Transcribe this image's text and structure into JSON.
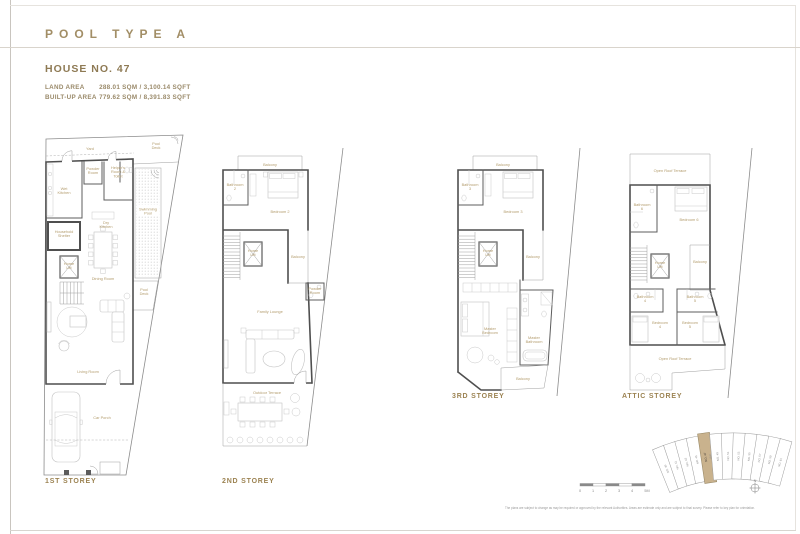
{
  "header": {
    "title": "POOL TYPE A",
    "house_name": "HOUSE NO. 47",
    "land_area_label": "LAND AREA",
    "land_area_value": "288.01 SQM / 3,100.14 SQFT",
    "built_up_area_label": "BUILT-UP AREA",
    "built_up_area_value": "779.62 SQM / 8,391.83 SQFT"
  },
  "plans": [
    {
      "label": "1ST STOREY",
      "rooms": {
        "yard": "Yard",
        "pool_deck_top": "Pool|Deck",
        "powder_room": "Powder|Room",
        "helpers_room": "Helper's|Room &|Toilet",
        "wet_kitchen": "Wet|Kitchen",
        "dry_kitchen": "Dry|Kitchen",
        "swimming_pool": "Swimming|Pool",
        "household_shelter": "Household|Shelter",
        "home_lift": "Home|Lift",
        "dining_room": "Dining Room",
        "pool_deck_bottom": "Pool|Deck",
        "living_room": "Living Room",
        "car_porch": "Car Porch"
      }
    },
    {
      "label": "2ND STOREY",
      "rooms": {
        "balcony_top": "Balcony",
        "bathroom": "Bathroom|2",
        "bedroom": "Bedroom 2",
        "home_lift": "Home|Lift",
        "balcony_right": "Balcony",
        "powder_room": "Powder|Room",
        "family_lounge": "Family Lounge",
        "outdoor_terrace": "Outdoor Terrace"
      }
    },
    {
      "label": "3RD STOREY",
      "rooms": {
        "balcony_top": "Balcony",
        "bathroom": "Bathroom|3",
        "bedroom": "Bedroom 3",
        "home_lift": "Home|Lift",
        "balcony_right": "Balcony",
        "master_bedroom": "Master|Bedroom",
        "master_bathroom": "Master|Bathroom",
        "balcony_bottom": "Balcony"
      }
    },
    {
      "label": "ATTIC STOREY",
      "rooms": {
        "roof_terrace_top": "Open Roof Terrace",
        "bathroom6": "Bathroom|6",
        "bedroom6": "Bedroom 6",
        "home_lift": "Home|Lift",
        "balcony_right": "Balcony",
        "bathroom4": "Bathroom|4",
        "bathroom5": "Bathroom|5",
        "bedroom4": "Bedroom|4",
        "bedroom5": "Bedroom|5",
        "roof_terrace_bottom": "Open Roof Terrace"
      }
    }
  ],
  "keyplan": {
    "lots": [
      "NO. 39",
      "NO. 41",
      "NO. 43",
      "NO. 45",
      "NO. 47",
      "NO. 49",
      "NO. 51",
      "NO. 53",
      "NO. 55",
      "NO. 57",
      "NO. 59",
      "NO. 61"
    ],
    "highlight_sub": "(PA)",
    "compass": "N"
  },
  "footer": {
    "scale_ticks": [
      "0",
      "1",
      "2",
      "3",
      "4",
      "5M"
    ],
    "disclaimer": "The plans are subject to change as may be required or approved by the relevant Authorities. Areas are estimate only and are subject to final survey. Please refer to key plan for orientation."
  },
  "colors": {
    "accent_gold": "#a28e66",
    "room_label": "#b39c6d",
    "wall": "#4f4f4f",
    "highlight_lot": "#c9b28d"
  }
}
